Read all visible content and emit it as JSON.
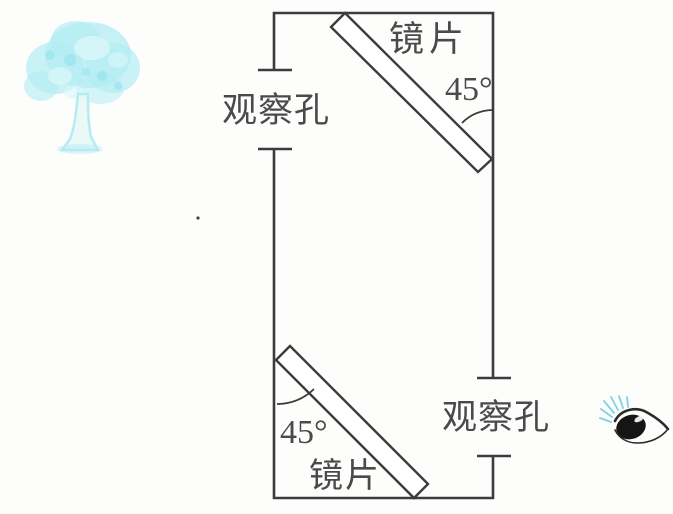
{
  "scene": {
    "background_color": "#fdfdfc",
    "line_color": "#3c3c3c",
    "text_color": "#4a4a4a"
  },
  "labels": {
    "top_mirror": "镜片",
    "top_angle": "45°",
    "left_hole": "观察孔",
    "bottom_mirror": "镜片",
    "bottom_angle": "45°",
    "right_hole": "观察孔"
  },
  "tree": {
    "canopy_color": "#b2ecf4",
    "canopy_light_color": "#d9f7f9",
    "canopy_deep_color": "#8adfe9",
    "trunk_color": "#e9f8f6"
  },
  "eye": {
    "outline_color": "#2b2b2b",
    "pupil_color": "#151515",
    "lash_color": "#6fcfe3"
  }
}
